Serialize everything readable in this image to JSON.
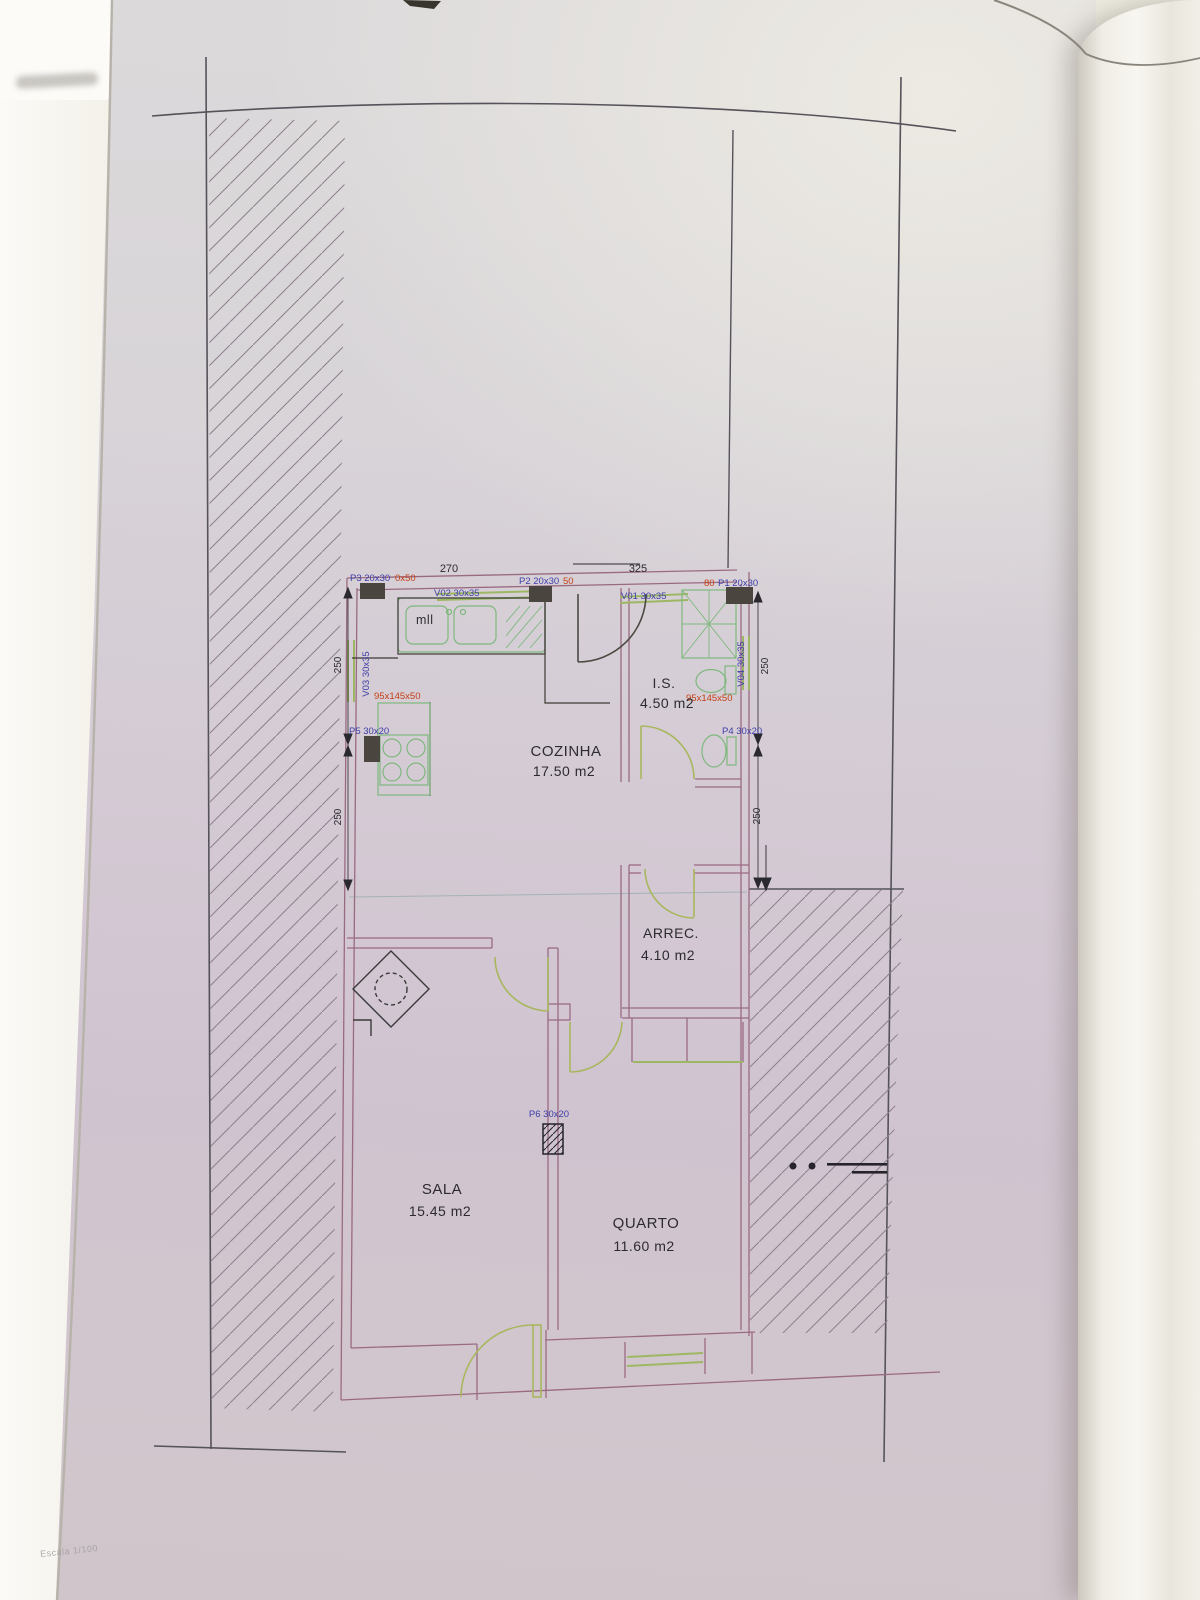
{
  "photo": {
    "scale_note": "Escala 1/100"
  },
  "plan": {
    "rooms": {
      "cozinha": {
        "name": "COZINHA",
        "area": "17.50 m2"
      },
      "is": {
        "name": "I.S.",
        "area": "4.50 m2"
      },
      "arrec": {
        "name": "ARREC.",
        "area": "4.10 m2"
      },
      "sala": {
        "name": "SALA",
        "area": "15.45 m2"
      },
      "quarto": {
        "name": "QUARTO",
        "area": "11.60 m2"
      }
    },
    "dimensions": {
      "top_left": "270",
      "top_right": "325",
      "side": "250"
    },
    "openings": {
      "p1": {
        "label": "P1 20x30",
        "red": "80"
      },
      "p2": {
        "label": "P2 20x30",
        "red": "50"
      },
      "p3": {
        "label": "P3 20x30",
        "red": "0x50"
      },
      "p4": {
        "label": "P4 30x20"
      },
      "p5": {
        "label": "P5 30x20"
      },
      "p6": {
        "label": "P6 30x20"
      },
      "v01": {
        "label": "V01 30x35"
      },
      "v02": {
        "label": "V02 30x35"
      },
      "v03": {
        "label": "V03 30x35"
      },
      "v04": {
        "label": "V04 30x35"
      }
    },
    "annotations": {
      "kitchen_unit": "95x145x50",
      "wc_unit": "95x145x50",
      "sink": "mll"
    }
  },
  "colors": {
    "paper": "#d5cbd4",
    "site_line": "#55525a",
    "wall": "#9a6a82",
    "fixture_green": "#7eb87e",
    "door_olive": "#a8b75e",
    "label_blue": "#3e3ea8",
    "label_red": "#c34016",
    "text_black": "#2b2930"
  }
}
